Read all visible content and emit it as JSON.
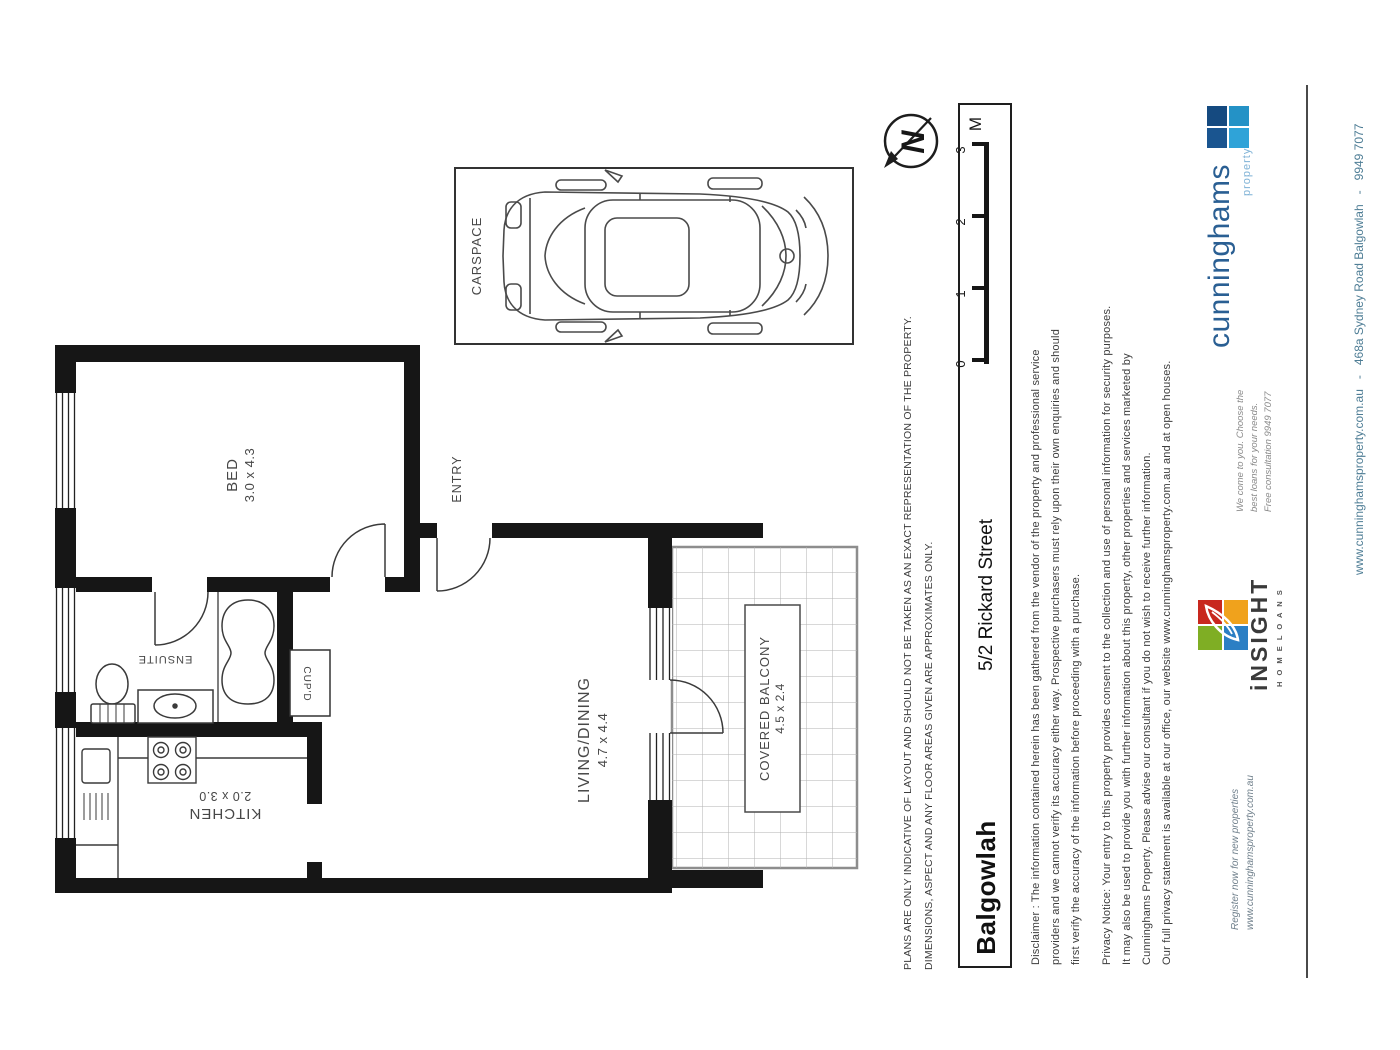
{
  "plan": {
    "rooms": {
      "bed": {
        "label": "BED",
        "dims": "3.0 x 4.3"
      },
      "entry": {
        "label": "ENTRY"
      },
      "living": {
        "label": "LIVING/DINING",
        "dims": "4.7 x 4.4"
      },
      "kitchen": {
        "label": "KITCHEN",
        "dims": "2.0 x 3.0"
      },
      "ensuite": {
        "label": "ENSUITE"
      },
      "cupboard": {
        "label": "CUP'D"
      },
      "balcony": {
        "label": "COVERED BALCONY",
        "dims": "4.5 x 2.4"
      },
      "carspace": {
        "label": "CARSPACE"
      }
    },
    "north": "N",
    "scale": {
      "t0": "0",
      "t1": "1",
      "t2": "2",
      "t3": "3",
      "unit": "M"
    }
  },
  "address": {
    "street": "5/2 Rickard Street",
    "suburb": "Balgowlah"
  },
  "notes": {
    "plans_1": "PLANS ARE ONLY INDICATIVE OF LAYOUT AND SHOULD NOT BE TAKEN AS AN EXACT REPRESENTATION OF THE PROPERTY.",
    "plans_2": "DIMENSIONS, ASPECT AND ANY FLOOR AREAS GIVEN ARE APPROXIMATES ONLY.",
    "disclaimer_1": "Disclaimer : The information contained herein has been gathered from the vendor of the property and professional service",
    "disclaimer_2": "providers and we cannot verify its accuracy either way.  Prospective purchasers must rely upon their own enquiries and should",
    "disclaimer_3": "first verify the accuracy of the information before proceeding with a purchase.",
    "privacy_1": "Privacy Notice: Your entry to this property provides consent to the collection and use of personal information for security purposes.",
    "privacy_2": "It may also be used to provide you with further information about this property, other properties and services marketed by",
    "privacy_3": "Cunninghams Property.  Please advise our consultant if you do not wish to receive further information.",
    "privacy_4": "Our full privacy statement is available at our office, our website www.cunninghamsproperty.com.au and at open houses."
  },
  "branding": {
    "cunninghams_name": "cunninghams",
    "cunninghams_tag": "property",
    "insight_name": "iNSIGHT",
    "insight_tag": "H O M E   L O A N S",
    "loans_1": "We come to you. Choose the",
    "loans_2": "best loans for your needs.",
    "loans_3": "Free consultation 9949 7077",
    "register_1": "Register now for new properties",
    "register_2": "www.cunninghamsproperty.com.au",
    "contact": "www.cunninghamsproperty.com.au   -   468a Sydney Road Balgowlah   -   9949 7077",
    "colors": {
      "cunninghams_navy": "#1a5590",
      "cunninghams_cyan": "#2fa3d8",
      "insight_red": "#c8281e",
      "insight_yellow": "#f0a21c",
      "insight_green": "#7fae24",
      "insight_blue": "#2b7fc4"
    }
  }
}
